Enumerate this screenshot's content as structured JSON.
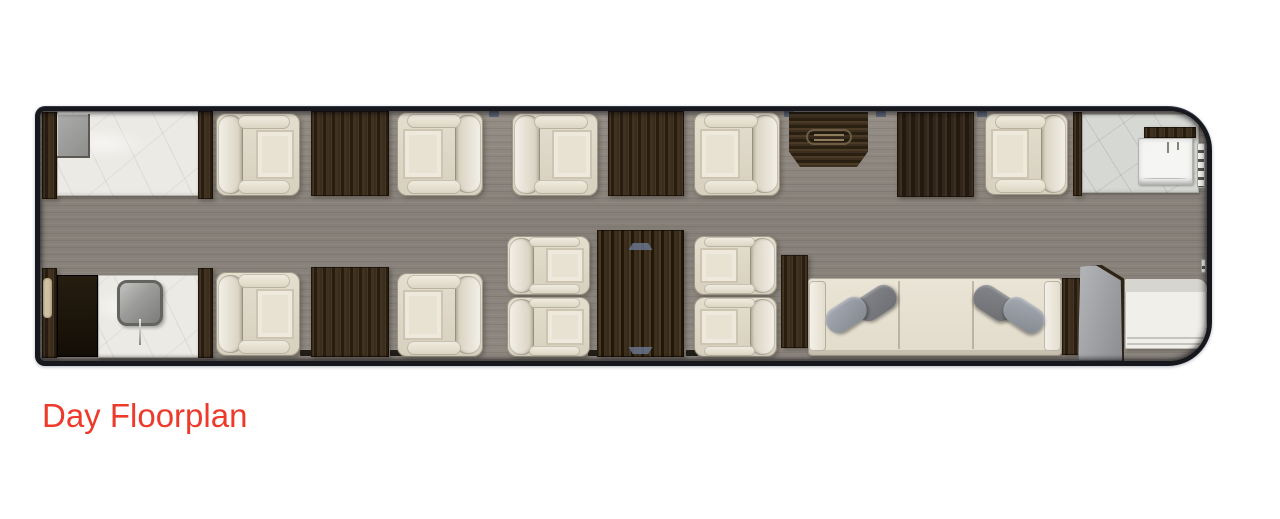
{
  "caption": {
    "label": "Day Floorplan",
    "color": "#ee3a2b"
  },
  "palette": {
    "page_background": "#ffffff",
    "fuselage_wall": "#16181e",
    "floor_wood": "#8b857e",
    "cabinet_wood": "#342818",
    "galley_marble": "#eceae5",
    "lavatory_marble": "#d6d8d4",
    "seat_leather": "#e4decf",
    "divan_fabric": "#e7e1d3",
    "pillow_gray": "#8d9095",
    "door_gray": "#a0a2a6",
    "caption_red": "#ee3a2b"
  },
  "floorplan": {
    "description": "Business jet cabin day floorplan, top-down view",
    "cabin": {
      "x": 35,
      "y": 106,
      "width": 1177,
      "height": 260
    },
    "items": [
      {
        "type": "notchb",
        "name": "window-frame-mark",
        "x": 260,
        "y": 239,
        "w": 12,
        "h": 6
      },
      {
        "type": "notchb",
        "name": "window-frame-mark",
        "x": 350,
        "y": 239,
        "w": 12,
        "h": 6
      },
      {
        "type": "notchb",
        "name": "window-frame-mark",
        "x": 548,
        "y": 239,
        "w": 12,
        "h": 6
      },
      {
        "type": "notchb",
        "name": "window-frame-mark",
        "x": 646,
        "y": 239,
        "w": 12,
        "h": 6
      },
      {
        "type": "notcht",
        "name": "window-frame-mark",
        "x": 449,
        "y": 0,
        "w": 10,
        "h": 6
      },
      {
        "type": "notcht",
        "name": "window-frame-mark",
        "x": 744,
        "y": 0,
        "w": 10,
        "h": 6
      },
      {
        "type": "notcht",
        "name": "window-frame-mark",
        "x": 836,
        "y": 0,
        "w": 10,
        "h": 6
      },
      {
        "type": "notcht",
        "name": "window-frame-mark",
        "x": 937,
        "y": 0,
        "w": 10,
        "h": 6
      },
      {
        "type": "woodstrip",
        "name": "forward-bulkhead-cabinet-upper",
        "x": 2,
        "y": 1,
        "w": 15,
        "h": 87
      },
      {
        "type": "marble",
        "name": "forward-galley-counter",
        "x": 17,
        "y": 0,
        "w": 142,
        "h": 85
      },
      {
        "type": "appliance",
        "name": "galley-appliance",
        "x": 17,
        "y": 3,
        "w": 33,
        "h": 44
      },
      {
        "type": "woodstrip",
        "name": "galley-partition-upper",
        "x": 158,
        "y": 0,
        "w": 15,
        "h": 88
      },
      {
        "type": "seat",
        "face": "right",
        "name": "club-seat-1",
        "x": 176,
        "y": 2,
        "w": 84,
        "h": 83
      },
      {
        "type": "table",
        "name": "side-table-1",
        "x": 271,
        "y": 0,
        "w": 78,
        "h": 85
      },
      {
        "type": "seat",
        "face": "left",
        "name": "club-seat-2",
        "x": 357,
        "y": 1,
        "w": 86,
        "h": 84
      },
      {
        "type": "seat",
        "face": "right",
        "name": "club-seat-3",
        "x": 472,
        "y": 2,
        "w": 86,
        "h": 83
      },
      {
        "type": "table",
        "name": "side-table-2",
        "x": 568,
        "y": 0,
        "w": 76,
        "h": 85
      },
      {
        "type": "seat",
        "face": "left",
        "name": "club-seat-4",
        "x": 654,
        "y": 1,
        "w": 86,
        "h": 84
      },
      {
        "type": "credenza",
        "name": "credenza",
        "x": 749,
        "y": 1,
        "w": 79,
        "h": 55
      },
      {
        "type": "closet",
        "name": "wardrobe-closet",
        "x": 857,
        "y": 1,
        "w": 77,
        "h": 85
      },
      {
        "type": "seat",
        "face": "left",
        "name": "club-seat-5",
        "x": 945,
        "y": 2,
        "w": 83,
        "h": 82
      },
      {
        "type": "woodstrip",
        "name": "lavatory-partition",
        "x": 1033,
        "y": 1,
        "w": 9,
        "h": 84
      },
      {
        "type": "marble",
        "variant": "gray",
        "name": "lavatory-counter",
        "x": 1042,
        "y": 3,
        "w": 117,
        "h": 79
      },
      {
        "type": "woodtrim",
        "name": "lavatory-shelf",
        "x": 1104,
        "y": 16,
        "w": 52,
        "h": 11
      },
      {
        "type": "lavsink",
        "name": "lavatory-sink",
        "x": 1098,
        "y": 27,
        "w": 55,
        "h": 47
      },
      {
        "type": "accessory",
        "name": "lavatory-towel-rail",
        "x": 1157,
        "y": 32,
        "w": 8,
        "h": 45
      },
      {
        "type": "woodstrip",
        "name": "forward-bulkhead-cabinet-lower",
        "x": 2,
        "y": 157,
        "w": 15,
        "h": 90
      },
      {
        "type": "tan",
        "name": "cabinet-handle-panel",
        "x": 3,
        "y": 167,
        "w": 9,
        "h": 40
      },
      {
        "type": "blackcab",
        "name": "galley-cabinet",
        "x": 17,
        "y": 164,
        "w": 41,
        "h": 82
      },
      {
        "type": "marble",
        "name": "galley-sink-counter",
        "x": 58,
        "y": 164,
        "w": 101,
        "h": 83
      },
      {
        "type": "gsink",
        "name": "galley-sink",
        "x": 77,
        "y": 169,
        "w": 46,
        "h": 46
      },
      {
        "type": "woodstrip",
        "name": "galley-partition-lower",
        "x": 158,
        "y": 157,
        "w": 15,
        "h": 90
      },
      {
        "type": "seat",
        "face": "right",
        "name": "club-seat-6",
        "x": 176,
        "y": 161,
        "w": 84,
        "h": 84
      },
      {
        "type": "table",
        "name": "side-table-3",
        "x": 271,
        "y": 156,
        "w": 78,
        "h": 90
      },
      {
        "type": "seat",
        "face": "left",
        "name": "club-seat-7",
        "x": 357,
        "y": 162,
        "w": 86,
        "h": 84
      },
      {
        "type": "seat",
        "face": "right",
        "name": "conference-seat-1",
        "x": 467,
        "y": 125,
        "w": 83,
        "h": 59
      },
      {
        "type": "seat",
        "face": "right",
        "name": "conference-seat-2",
        "x": 467,
        "y": 186,
        "w": 83,
        "h": 60
      },
      {
        "type": "conftable",
        "name": "conference-table",
        "x": 557,
        "y": 119,
        "w": 87,
        "h": 127
      },
      {
        "type": "seat",
        "face": "left",
        "name": "conference-seat-3",
        "x": 654,
        "y": 125,
        "w": 83,
        "h": 59
      },
      {
        "type": "seat",
        "face": "left",
        "name": "conference-seat-4",
        "x": 654,
        "y": 186,
        "w": 83,
        "h": 60
      },
      {
        "type": "woodstrip",
        "name": "divan-side-table-left",
        "x": 741,
        "y": 144,
        "w": 27,
        "h": 93
      },
      {
        "type": "divan",
        "name": "divan",
        "x": 768,
        "y": 167,
        "w": 254,
        "h": 78
      },
      {
        "type": "woodstrip",
        "name": "divan-side-table-right",
        "x": 1022,
        "y": 167,
        "w": 18,
        "h": 77
      },
      {
        "type": "door",
        "name": "pocket-door",
        "x": 1038,
        "y": 154,
        "w": 46,
        "h": 96
      },
      {
        "type": "bench",
        "name": "aft-bench",
        "x": 1085,
        "y": 168,
        "w": 82,
        "h": 70
      },
      {
        "type": "accessory",
        "name": "coat-hook",
        "x": 1161,
        "y": 148,
        "w": 5,
        "h": 14
      }
    ]
  }
}
